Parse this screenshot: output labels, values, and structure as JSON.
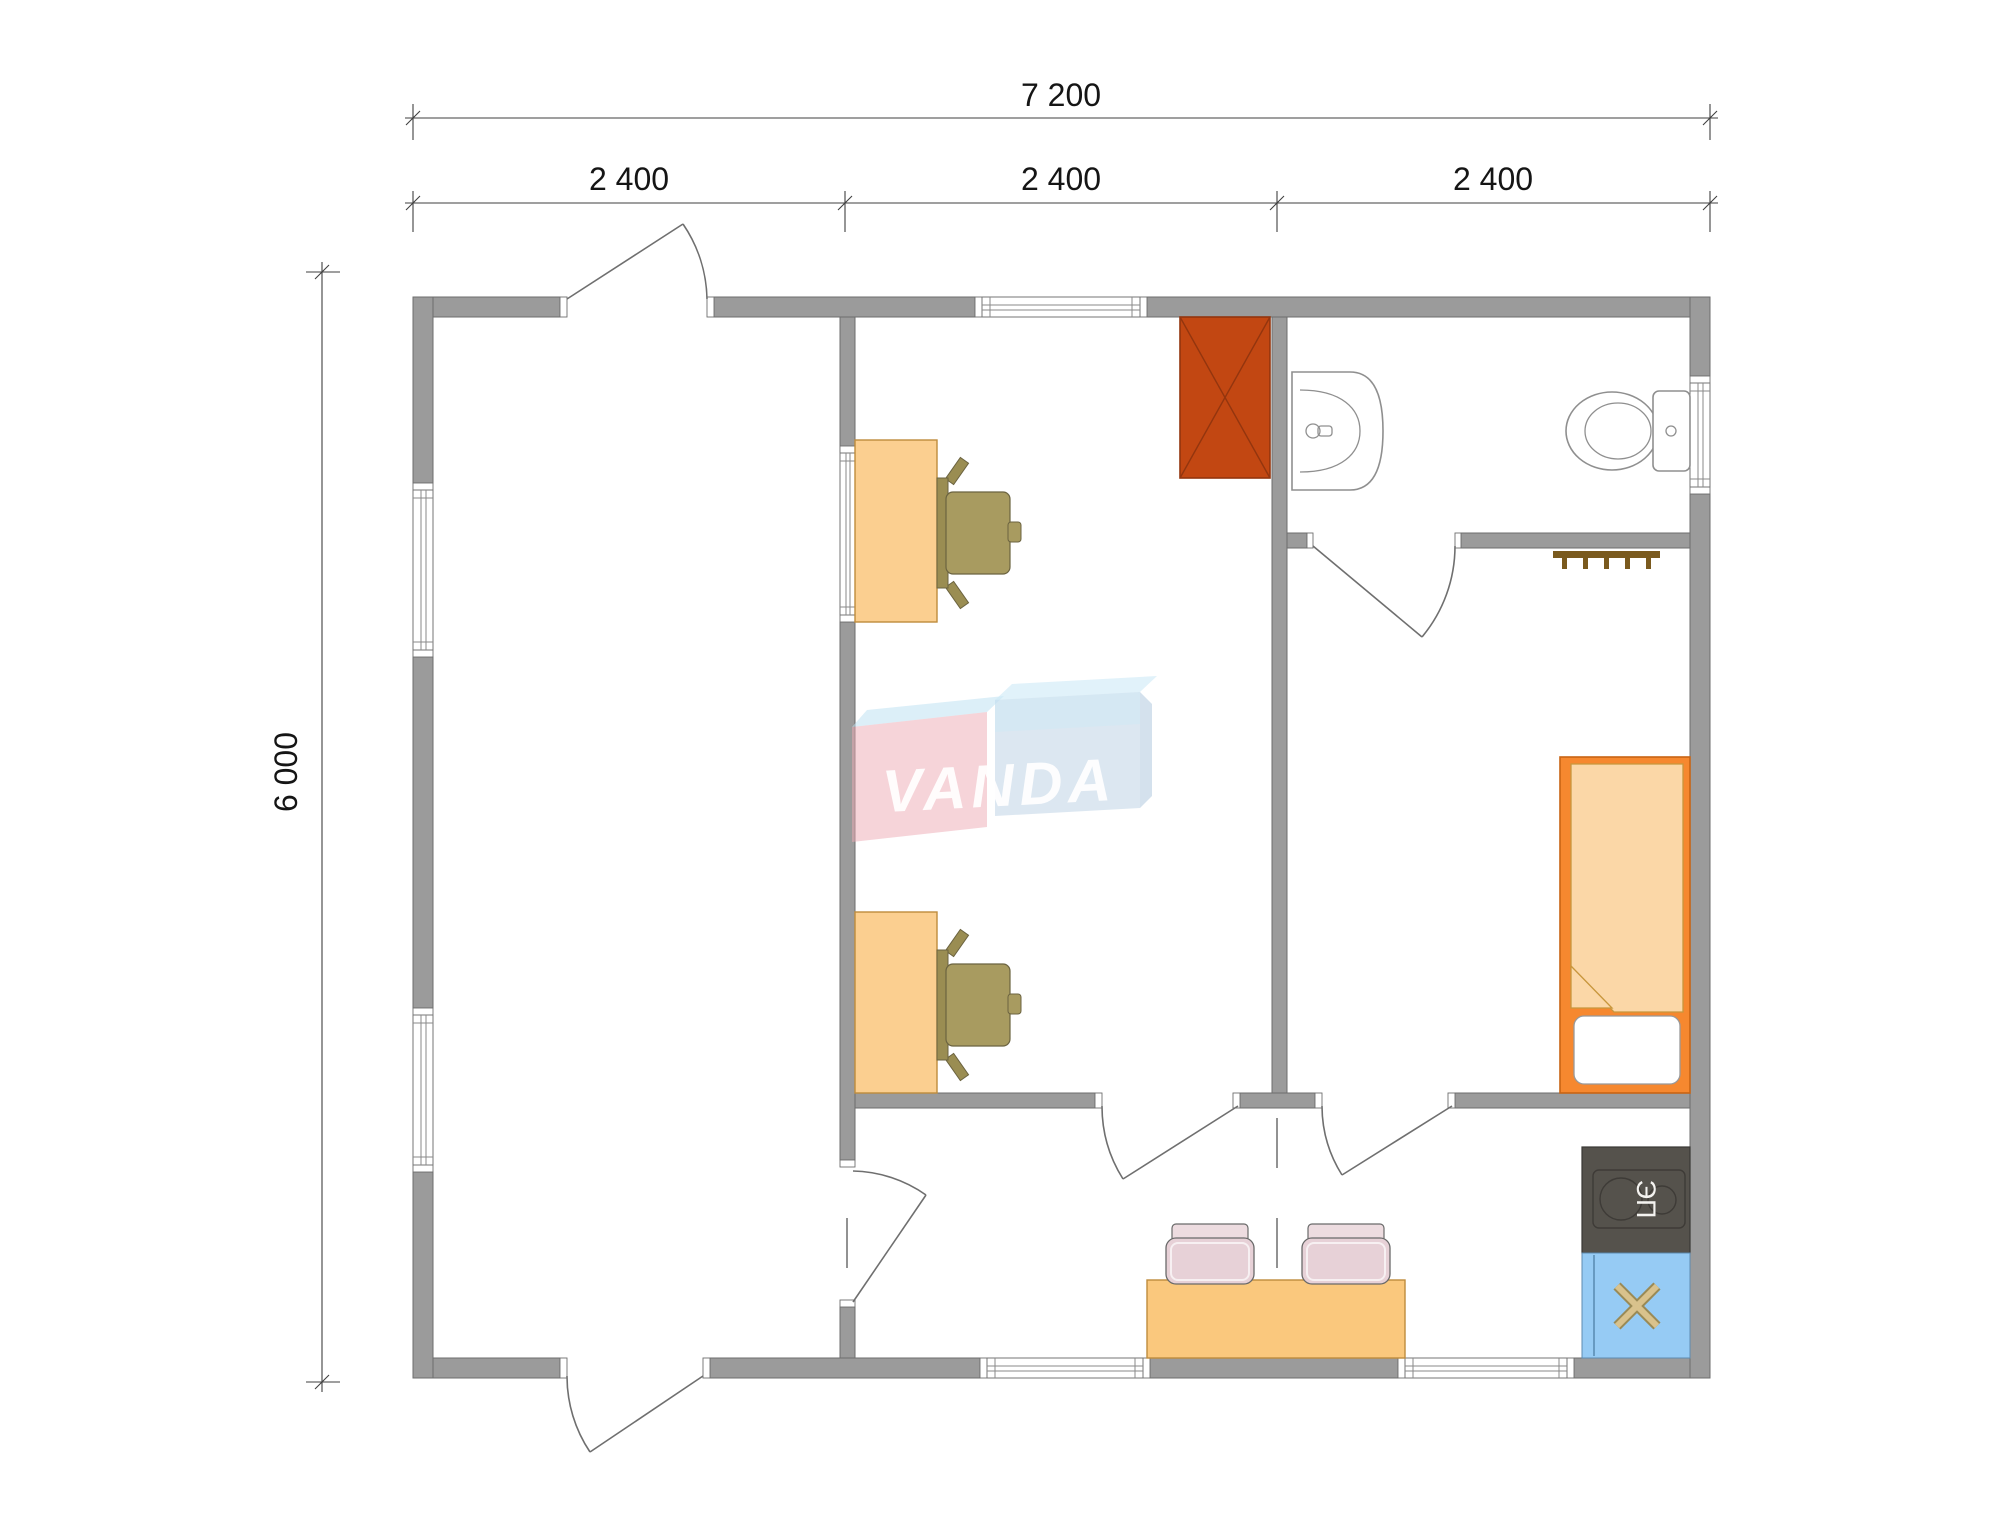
{
  "dimensions": {
    "total_width": "7 200",
    "segments": [
      "2 400",
      "2 400",
      "2 400"
    ],
    "total_height": "6 000"
  },
  "watermark": {
    "text": "VANDA",
    "text_color": "#FFFFFF",
    "pink_block": "#EDA9B4",
    "blue_block": "#B9CFE4",
    "top_flap": "#BFE2F2",
    "light_band": "#CDE9F7",
    "right_bevel": "#A9C4DC"
  },
  "equipment_labels": {
    "electric_stove": "ЭП"
  },
  "colors": {
    "wall": "#9B9B9B",
    "wall_outline": "#6E6E6E",
    "desk": "#FBCF90",
    "desk_border": "#BE8C3C",
    "chair_olive": "#A89B60",
    "chair_olive_dark": "#9A8D52",
    "wardrobe": "#C24712",
    "wardrobe_line": "#93350E",
    "bed_frame": "#F6882F",
    "bed_blanket": "#FBD7A7",
    "pillow": "#FFFFFF",
    "table": "#FAC87D",
    "chair_pink": "#E7D1D7",
    "chair_pink_light": "#EDDCE0",
    "stove": "#55524C",
    "sink_unit_blue": "#96CBF4",
    "sink_cross": "#CBB176",
    "hanger": "#7A5A1E",
    "dimension_text": "#151515"
  }
}
